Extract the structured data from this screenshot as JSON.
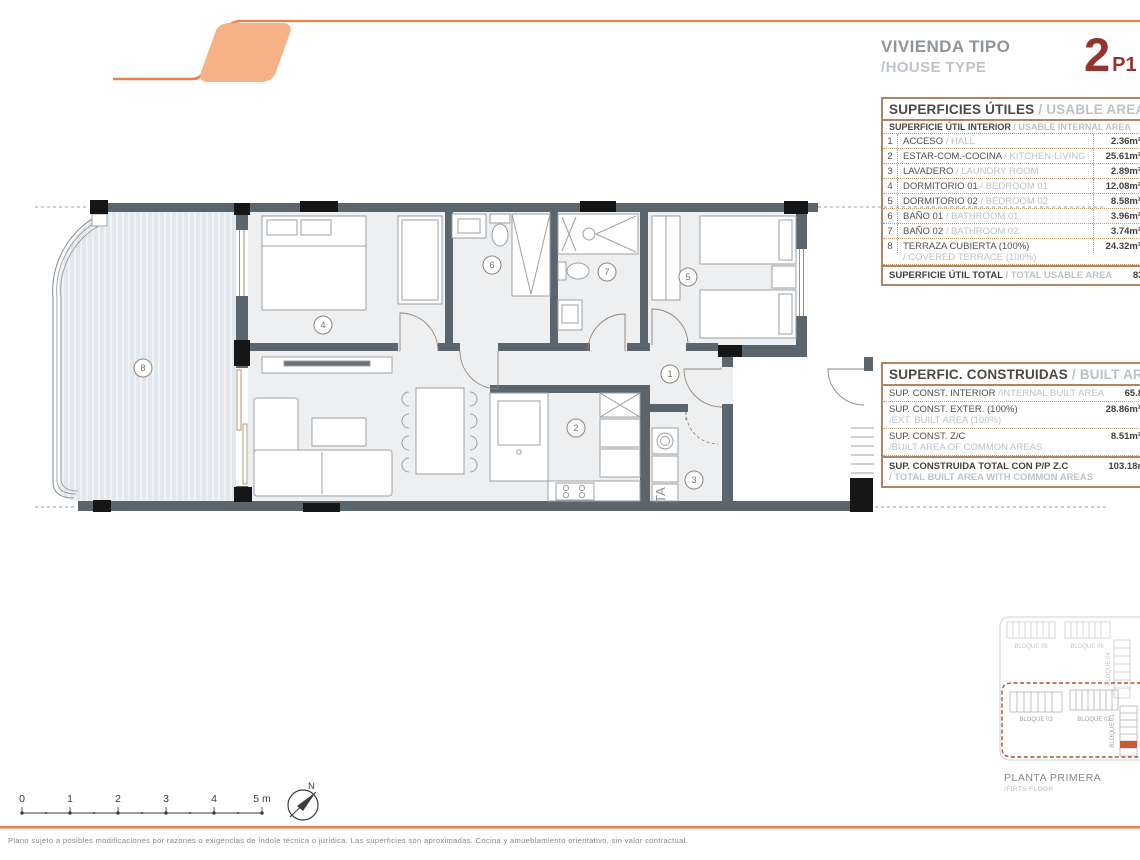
{
  "header": {
    "project_label_es": "VIVIENDA TIPO",
    "project_label_en": "/HOUSE TYPE",
    "type_number": "2",
    "type_code": "P1"
  },
  "usable": {
    "title_es": "SUPERFICIES ÚTILES",
    "title_en": " / USABLE AREA",
    "subtitle_es": "SUPERFICIE ÚTIL INTERIOR",
    "subtitle_en": " / USABLE INTERNAL AREA",
    "rows": [
      {
        "num": "1",
        "es": "ACCESO",
        "en": " / HALL",
        "value": "2.36m²"
      },
      {
        "num": "2",
        "es": "ESTAR-COM.-COCINA",
        "en": " / KITCHEN-LIVING",
        "value": "25.61m²"
      },
      {
        "num": "3",
        "es": "LAVADERO",
        "en": " / LAUNDRY ROOM",
        "value": "2.89m²"
      },
      {
        "num": "4",
        "es": "DORMITORIO 01",
        "en": " / BEDROOM 01",
        "value": "12.08m²"
      },
      {
        "num": "5",
        "es": "DORMITORIO 02",
        "en": " / BEDROOM 02",
        "value": "8.58m²"
      },
      {
        "num": "6",
        "es": "BAÑO 01",
        "en": " / BATHROOM 01",
        "value": "3.96m²"
      },
      {
        "num": "7",
        "es": "BAÑO 02",
        "en": " / BATHROOM 02",
        "value": "3.74m²"
      },
      {
        "num": "8",
        "es": "TERRAZA CUBIERTA (100%)",
        "en": "/ COVERED TERRACE (100%)",
        "value": "24.32m²"
      }
    ],
    "total_es": "SUPERFICIE ÚTIL TOTAL",
    "total_en": " / TOTAL USABLE AREA",
    "total_value": "83.54m²"
  },
  "built": {
    "title_es": "SUPERFIC. CONSTRUIDAS",
    "title_en": " / BUILT AREA",
    "rows": [
      {
        "es": "SUP. CONST. INTERIOR",
        "en": " /INTERNAL BUILT AREA",
        "en2": "",
        "value": "65.81m²"
      },
      {
        "es": "SUP. CONST. EXTER. (100%)",
        "en": "",
        "en2": "/EXT. BUILT AREA (100%)",
        "value": "28.86m²"
      },
      {
        "es": "SUP. CONST. Z/C",
        "en": "",
        "en2": "/BUILT AREA OF COMMON AREAS",
        "value": "8.51m²"
      }
    ],
    "total_es": "SUP. CONSTRUIDA TOTAL CON P/P Z.C",
    "total_en2": "/ TOTAL BUILT AREA WITH COMMON AREAS",
    "total_value": "103.18m²"
  },
  "plan": {
    "rooms": [
      "1",
      "2",
      "3",
      "4",
      "5",
      "6",
      "7",
      "8"
    ],
    "laundry_label": "TA"
  },
  "scale": {
    "labels": [
      "0",
      "1",
      "2",
      "3",
      "4",
      "5 m"
    ]
  },
  "compass": {
    "north": "N"
  },
  "site": {
    "b05": "BLOQUE 05",
    "b06": "BLOQUE 06",
    "b04": "BLOQUE 04",
    "b03": "BLOQUE 03",
    "b02": "BLOQUE 02",
    "b01": "BLOQUE 01",
    "title": "PLANTA PRIMERA",
    "subtitle": "/FIRTS FLOOR"
  },
  "footer": {
    "disclaimer": "Plano sujeto a posibles modificaciones por razones o exigencias de índole técnica o jurídica. Las superficies son aproximadas. Cocina y amueblamiento orientativo, sin valor contractual."
  },
  "colors": {
    "accent_orange": "#e8824c",
    "accent_fill": "#f6b285",
    "heading_red": "#93352c",
    "wall_gray": "#5b656e",
    "table_border": "#b5845e",
    "highlight_unit": "#cc5c30"
  }
}
